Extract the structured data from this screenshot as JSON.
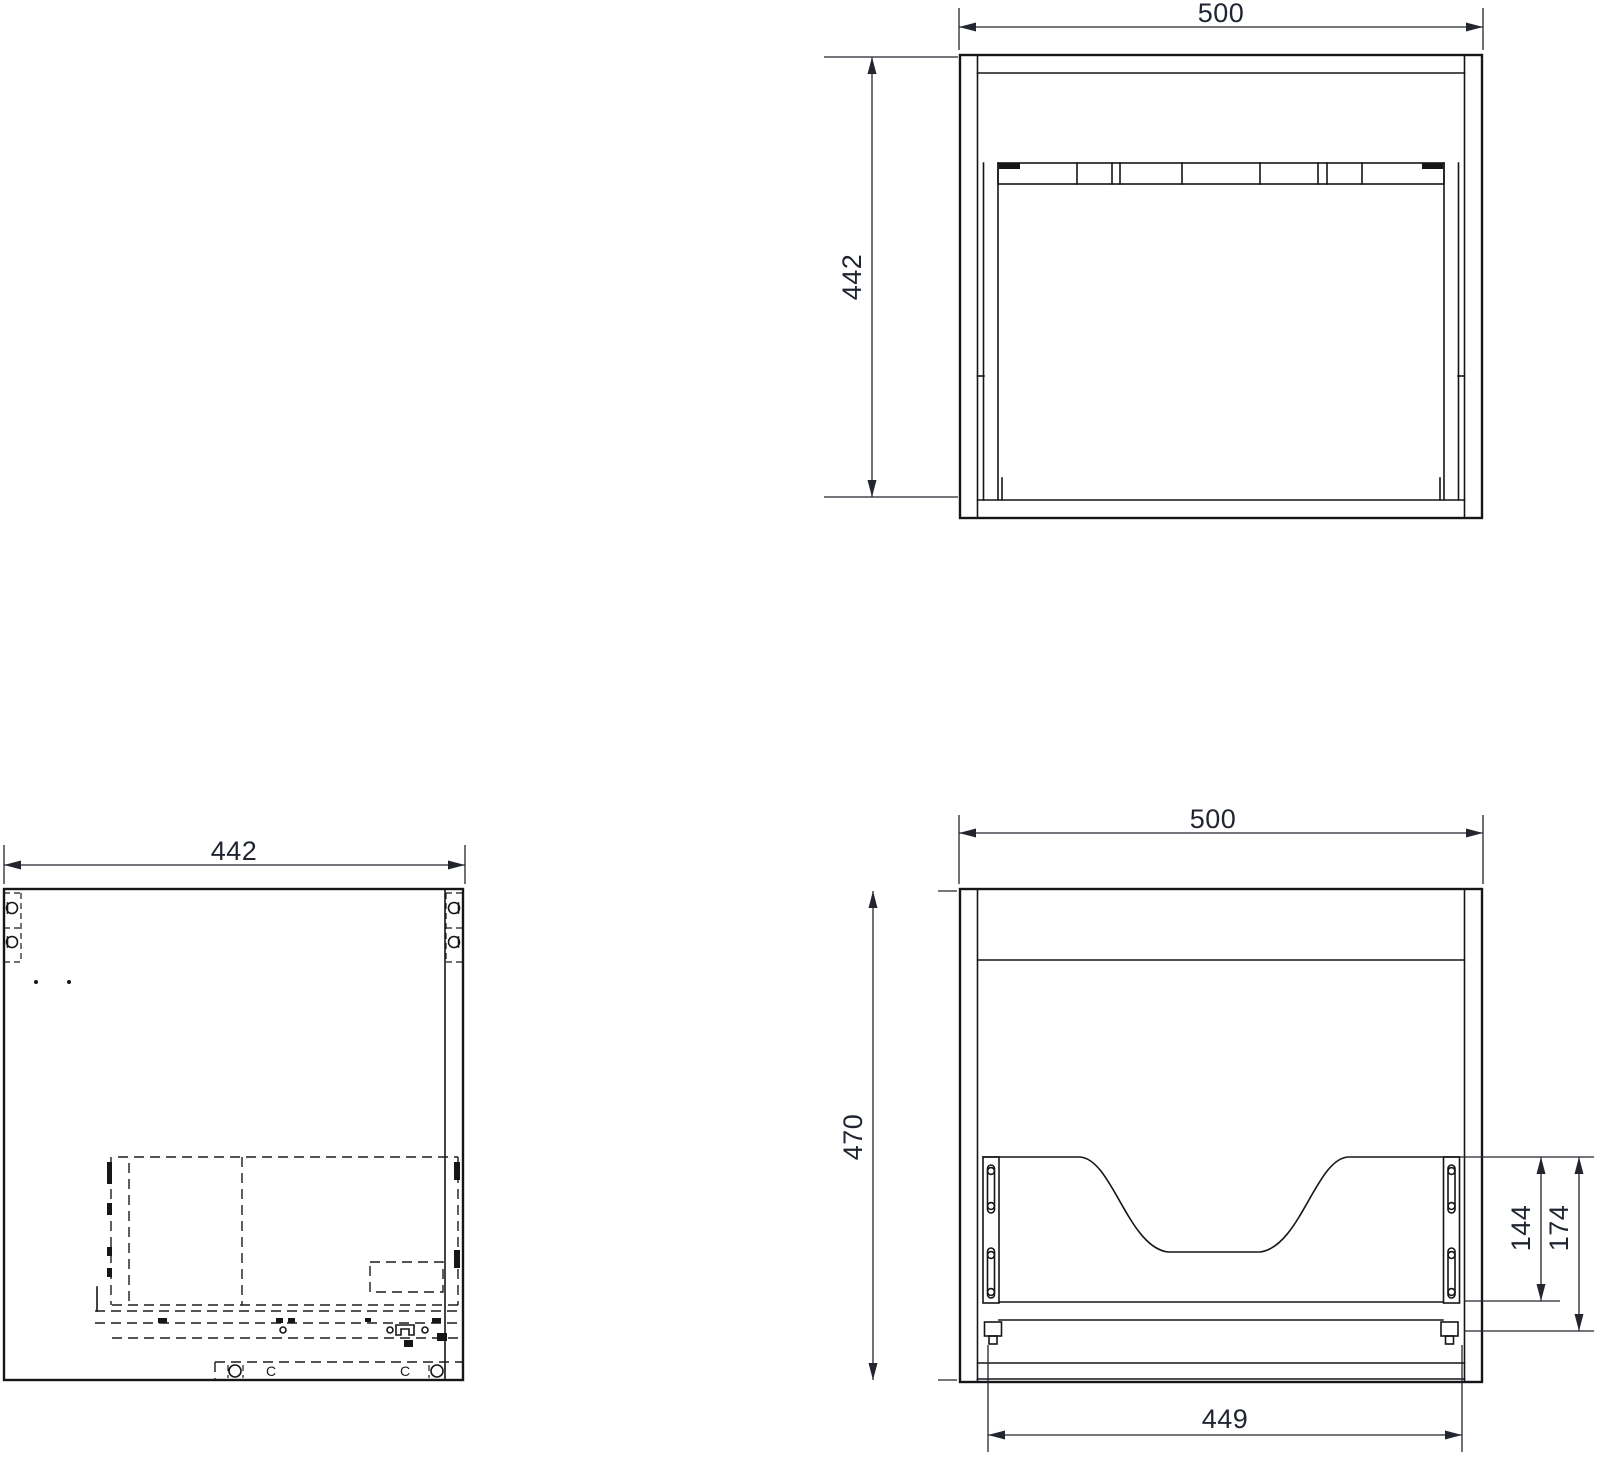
{
  "colors": {
    "line": "#161619",
    "dimension": "#23262f",
    "background": "#ffffff"
  },
  "dimensions": {
    "top_view": {
      "width": "500",
      "depth": "442"
    },
    "side_view": {
      "depth": "442",
      "cam_marker": "C"
    },
    "front_view": {
      "width": "500",
      "height": "470",
      "basin_drop_inner": "144",
      "basin_drop_outer": "174",
      "inner_width": "449"
    }
  }
}
